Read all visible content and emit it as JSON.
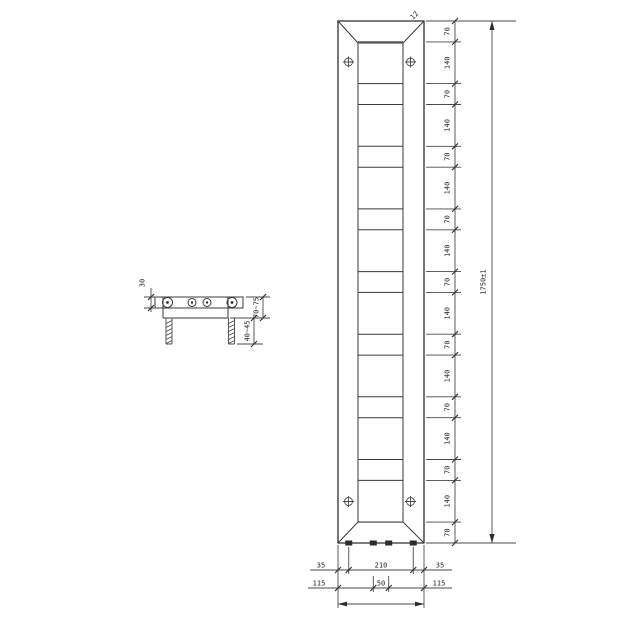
{
  "drawing": {
    "front_view": {
      "bevel_label": "12",
      "height_segments": [
        "70",
        "140",
        "70",
        "140",
        "70",
        "140",
        "70",
        "140",
        "70",
        "140",
        "70",
        "140",
        "70",
        "140",
        "70",
        "140",
        "70"
      ],
      "overall_height_label": "1750±1",
      "width_dims": {
        "row1_left": "35",
        "row1_center": "210",
        "row1_right": "35",
        "row2_left": "115",
        "row2_center": "50",
        "row2_right": "115",
        "overall_width_label": "280±1"
      }
    },
    "side_view": {
      "depth_label": "30",
      "wall_distance_label": "70~75",
      "rod_length_label": "40~45"
    }
  }
}
